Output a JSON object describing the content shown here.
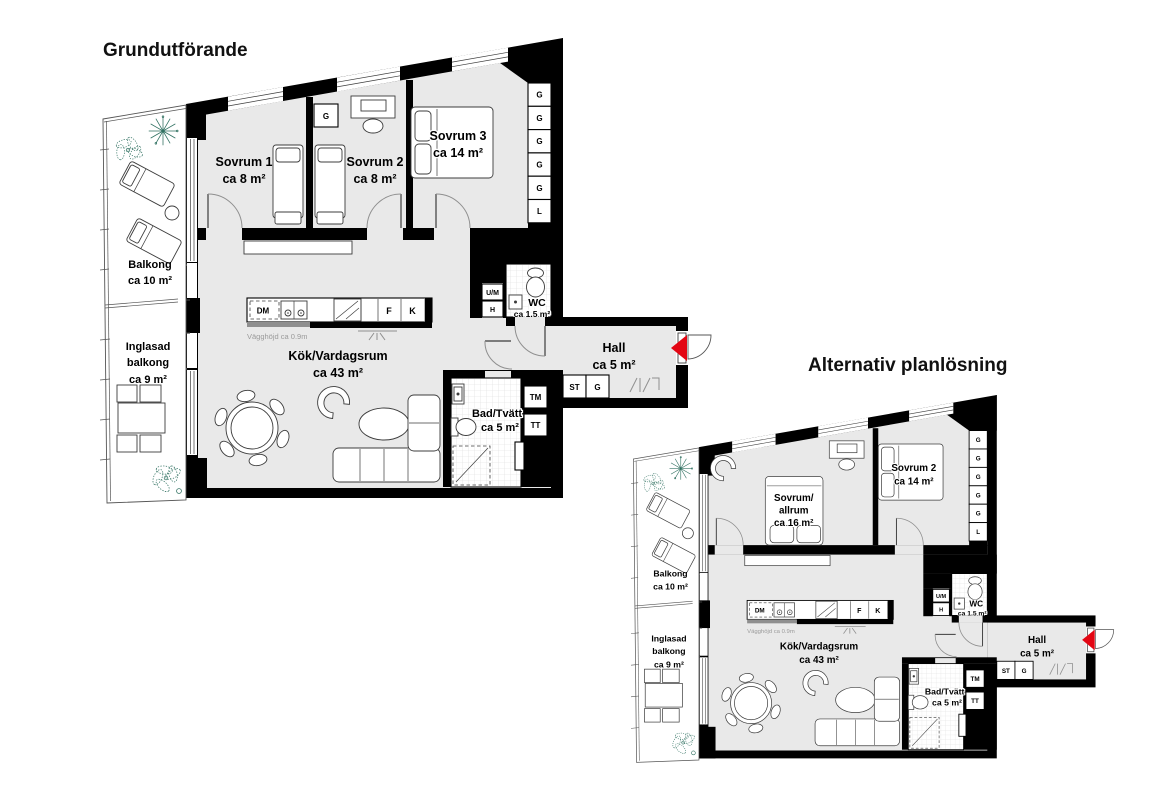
{
  "colors": {
    "wall": "#000000",
    "floor": "#e9e9e9",
    "entrance_arrow_red": "#e30613",
    "plant_teal": "#2f7060"
  },
  "plan1": {
    "title": "Grundutförande",
    "rooms": {
      "sovrum1": {
        "name": "Sovrum 1",
        "area": "ca 8 m²"
      },
      "sovrum2": {
        "name": "Sovrum 2",
        "area": "ca 8 m²"
      },
      "sovrum3": {
        "name": "Sovrum 3",
        "area": "ca 14 m²"
      }
    }
  },
  "plan2": {
    "title": "Alternativ planlösning",
    "rooms": {
      "sovrum_allrum": {
        "name_line1": "Sovrum/",
        "name_line2": "allrum",
        "area": "ca 16 m²"
      },
      "sovrum2": {
        "name": "Sovrum 2",
        "area": "ca 14 m²"
      }
    }
  },
  "shared": {
    "balkong": {
      "name": "Balkong",
      "area": "ca 10 m²"
    },
    "inglasad_balkong": {
      "name_line1": "Inglasad",
      "name_line2": "balkong",
      "area": "ca 9 m²"
    },
    "kok_vardagsrum": {
      "name": "Kök/Vardagsrum",
      "area": "ca 43 m²"
    },
    "hall": {
      "name": "Hall",
      "area": "ca 5 m²"
    },
    "wc": {
      "name": "WC",
      "area": "ca 1.5 m²"
    },
    "bad_tvatt": {
      "name": "Bad/Tvätt",
      "area": "ca 5 m²"
    },
    "wall_height_note": "Vägghöjd ca 0.9m",
    "wardrobe_column": [
      "G",
      "G",
      "G",
      "G",
      "G",
      "L"
    ],
    "fixtures": {
      "dm": "DM",
      "f": "F",
      "k": "K",
      "g": "G",
      "st": "ST",
      "tm": "TM",
      "tt": "TT",
      "um": "U/M",
      "h": "H"
    }
  }
}
